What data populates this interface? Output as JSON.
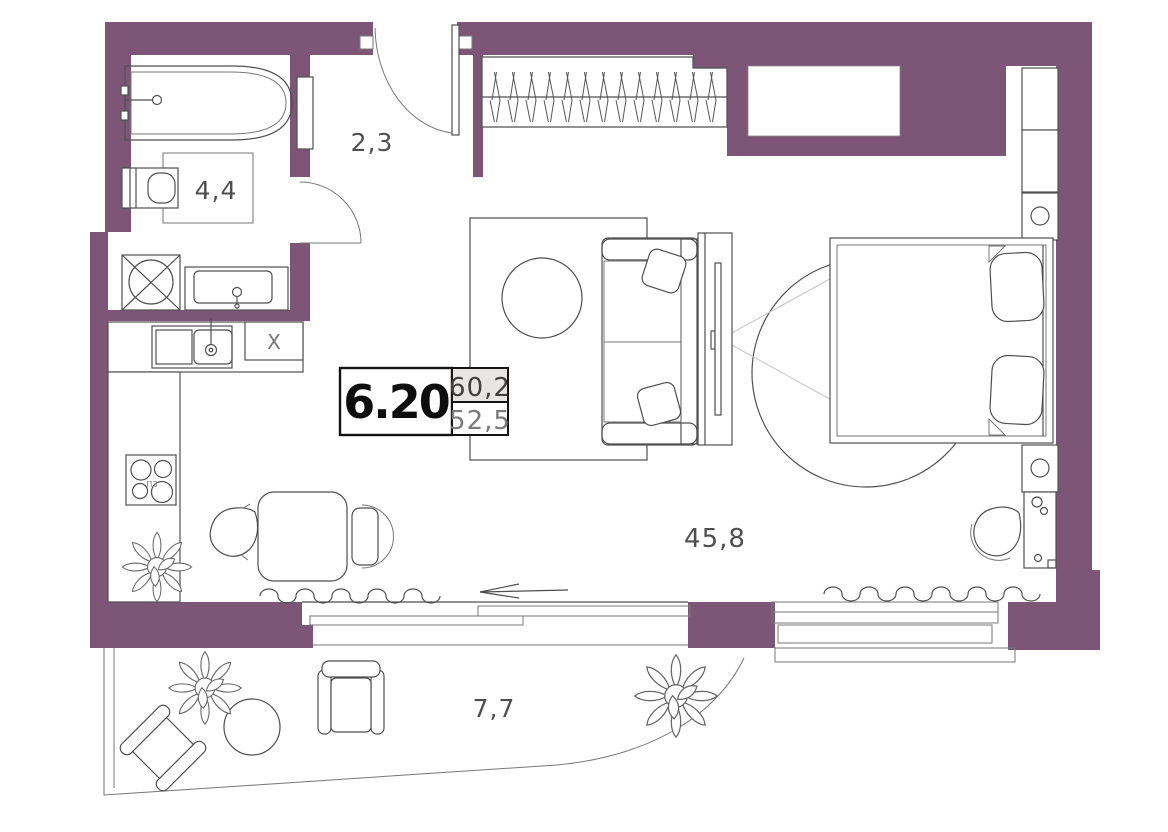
{
  "plan": {
    "unit_number": "6.20",
    "areas": {
      "total": "60,2",
      "living": "52,5"
    },
    "room_labels": {
      "hallway": "2,3",
      "bathroom": "4,4",
      "living_room": "45,8",
      "balcony": "7,7"
    },
    "kitchen": {
      "stove_symbol": "ПЗ",
      "cabinet_symbol": "X"
    },
    "colors": {
      "wall": "#7d5677",
      "line": "#4f4f4f",
      "unit_text": "#0d0d0d",
      "area_cell_bg": "#e8e6e5",
      "label_text": "#4f4f4f"
    }
  }
}
